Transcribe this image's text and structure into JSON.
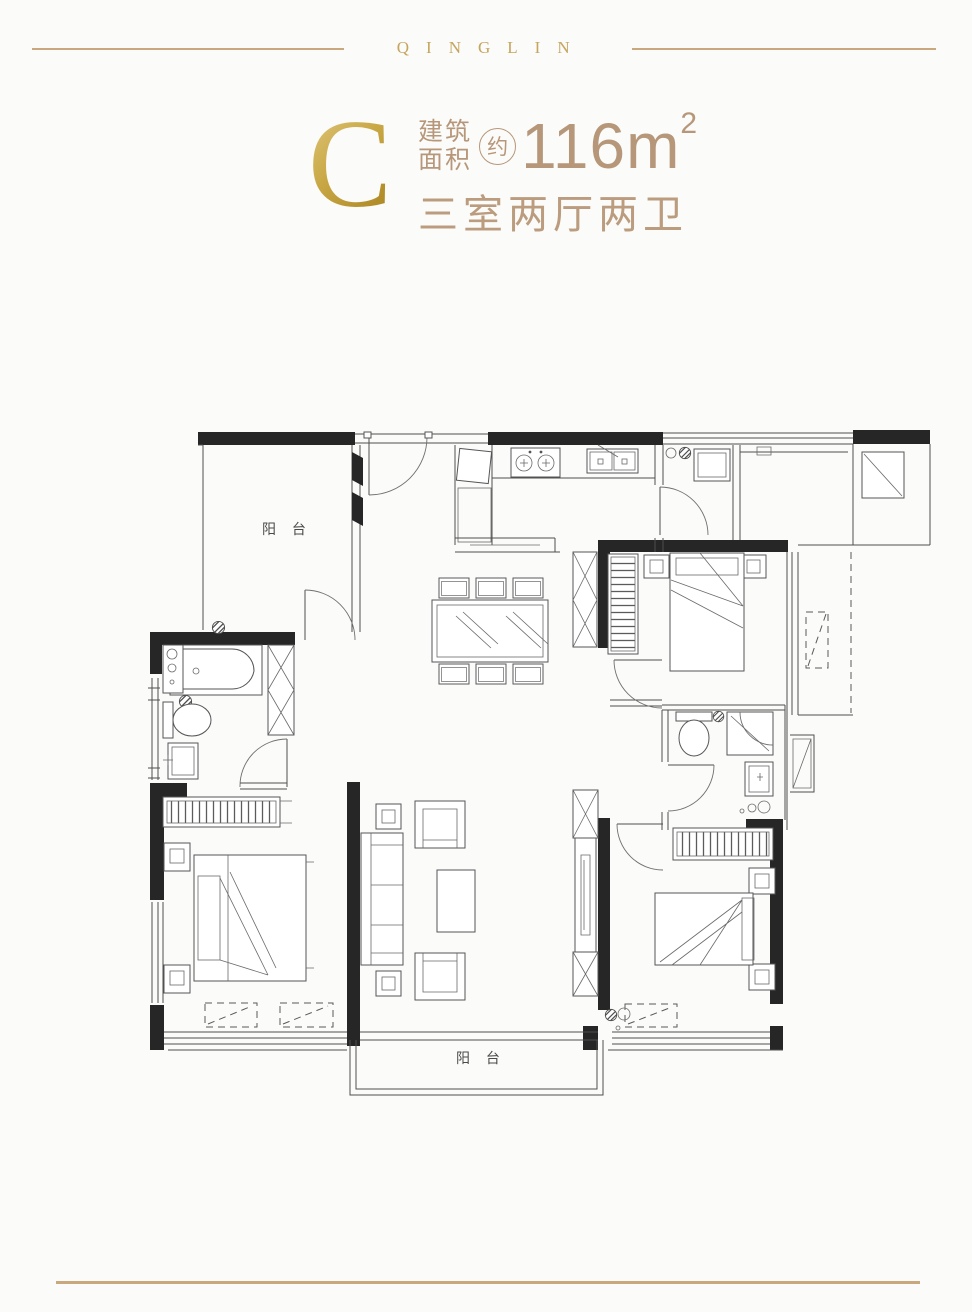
{
  "page": {
    "background": "#fbfbf9"
  },
  "brand": {
    "wordmark": "QINGLIN"
  },
  "header": {
    "unit_letter": "C",
    "area_label_top": "建筑",
    "area_label_bottom": "面积",
    "approx_badge": "约",
    "area_value": "116",
    "area_unit": "m",
    "area_superscript": "2",
    "layout_text": "三室两厅两卫"
  },
  "floor_plan": {
    "balcony_top_label": "阳 台",
    "balcony_bottom_label": "阳 台"
  },
  "colors": {
    "gold_accent": "#c6a55e",
    "gold_gradient_start": "#e0c87e",
    "gold_gradient_end": "#a8821f",
    "tan_text": "#b7977a",
    "divider_gold": "#c9a87e",
    "wall_black": "#262626",
    "line_gray": "#4f4f4f"
  }
}
